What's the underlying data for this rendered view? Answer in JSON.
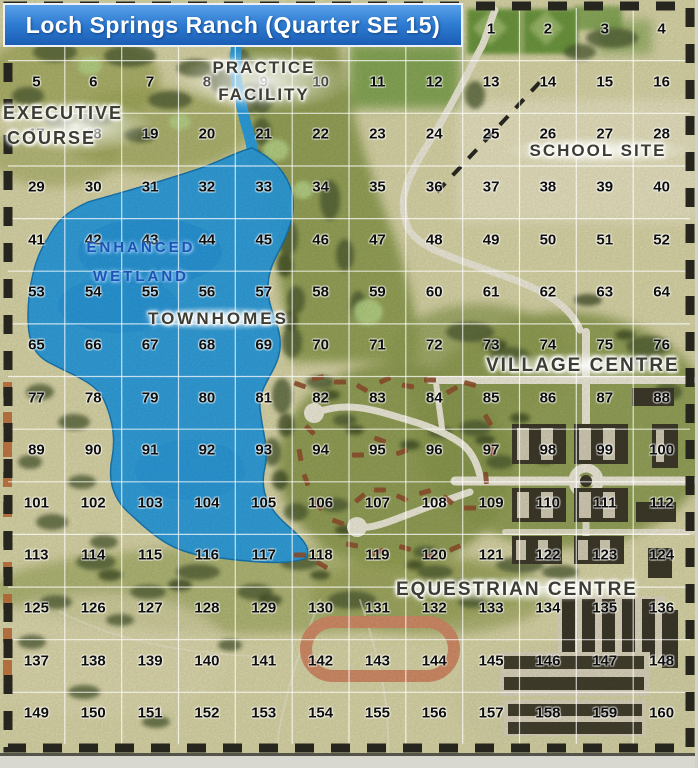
{
  "title": "Loch Springs Ranch (Quarter SE 15)",
  "labels": {
    "practice_facility": {
      "line1": "PRACTICE",
      "line2": "FACILITY"
    },
    "executive_course": {
      "line1": "EXECUTIVE",
      "line2": "COURSE"
    },
    "school_site": "SCHOOL SITE",
    "enhanced_wetland": {
      "line1": "ENHANCED",
      "line2": "WETLAND"
    },
    "townhomes": "TOWNHOMES",
    "village_centre": "VILLAGE CENTRE",
    "equestrian_centre": "EQUESTRIAN CENTRE"
  },
  "grid": {
    "rows": 14,
    "cols": 12,
    "numbers": [
      1,
      2,
      3,
      4,
      5,
      6,
      7,
      8,
      9,
      10,
      11,
      12,
      13,
      14,
      15,
      16,
      17,
      18,
      19,
      20,
      21,
      22,
      23,
      24,
      25,
      26,
      27,
      28,
      29,
      30,
      31,
      32,
      33,
      34,
      35,
      36,
      37,
      38,
      39,
      40,
      41,
      42,
      43,
      44,
      45,
      46,
      47,
      48,
      49,
      50,
      51,
      52,
      53,
      54,
      55,
      56,
      57,
      58,
      59,
      60,
      61,
      62,
      63,
      64,
      65,
      66,
      67,
      68,
      69,
      70,
      71,
      72,
      73,
      74,
      75,
      76,
      77,
      78,
      79,
      80,
      81,
      82,
      83,
      84,
      85,
      86,
      87,
      88,
      89,
      90,
      91,
      92,
      93,
      94,
      95,
      96,
      97,
      98,
      99,
      100,
      101,
      102,
      103,
      104,
      105,
      106,
      107,
      108,
      109,
      110,
      111,
      112,
      113,
      114,
      115,
      116,
      117,
      118,
      119,
      120,
      121,
      122,
      123,
      124,
      125,
      126,
      127,
      128,
      129,
      130,
      131,
      132,
      133,
      134,
      135,
      136,
      137,
      138,
      139,
      140,
      141,
      142,
      143,
      144,
      145,
      146,
      147,
      148,
      149,
      150,
      151,
      152,
      153,
      154,
      155,
      156,
      157,
      158,
      159,
      160
    ]
  },
  "colors": {
    "title_bar_blue": "#2e7cd2",
    "lake_blue": "#2ea2e2",
    "terrain_tan": "#dfdbac",
    "fairway_green": "#95a354",
    "tree_green": "#4e5c31",
    "track_orange": "#d6906a",
    "wetland_text_blue": "#1d53b4",
    "boundary_dash_black": "#26261e"
  }
}
